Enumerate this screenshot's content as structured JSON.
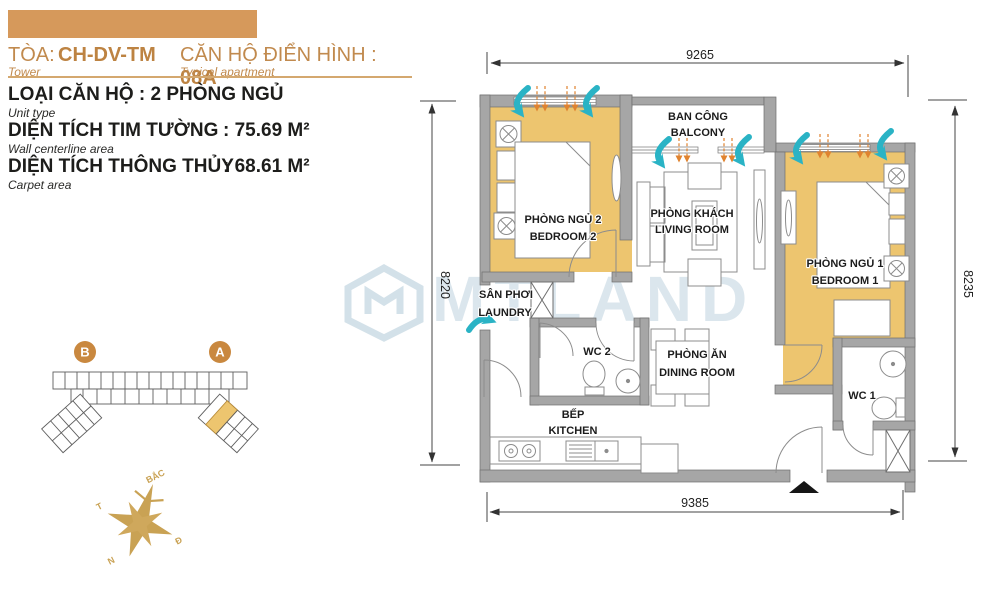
{
  "header": {
    "tower_label": "TÒA:",
    "tower_value": "CH-DV-TM",
    "tower_sub": "Tower",
    "apt_label": "CĂN HỘ ĐIỂN HÌNH : ",
    "apt_value": "08A",
    "apt_sub": "Typical apartment"
  },
  "specs": {
    "unit_type": "LOẠI CĂN HỘ : 2 PHÒNG NGỦ",
    "unit_type_sub": "Unit type",
    "wall_area_label": "DIỆN TÍCH TIM TƯỜNG",
    "wall_area_value": ": 75.69 M²",
    "wall_area_sub": "Wall centerline area",
    "carpet_area_label": "DIỆN TÍCH THÔNG THỦY",
    "carpet_area_value": ": 68.61 M²",
    "carpet_area_sub": "Carpet area"
  },
  "sitemap": {
    "tower_b": "B",
    "tower_a": "A"
  },
  "compass": {
    "north": "BẮC",
    "west": "T",
    "east": "Đ",
    "south": "N"
  },
  "watermark": "MTLAND",
  "floorplan": {
    "dims": {
      "top": "9265",
      "left": "8220",
      "right": "8235",
      "bottom": "9385"
    },
    "rooms": {
      "balcony": {
        "vi": "BAN CÔNG",
        "en": "BALCONY"
      },
      "bedroom2": {
        "vi": "PHÒNG NGỦ 2",
        "en": "BEDROOM 2"
      },
      "bedroom1": {
        "vi": "PHÒNG NGỦ 1",
        "en": "BEDROOM 1"
      },
      "living": {
        "vi": "PHÒNG KHÁCH",
        "en": "LIVING ROOM"
      },
      "laundry": {
        "vi": "SÂN PHƠI",
        "en": "LAUNDRY"
      },
      "dining": {
        "vi": "PHÒNG ĂN",
        "en": "DINING ROOM"
      },
      "kitchen": {
        "vi": "BẾP",
        "en": "KITCHEN"
      },
      "wc1": {
        "label": "WC 1"
      },
      "wc2": {
        "label": "WC 2"
      }
    }
  },
  "colors": {
    "header_bar": "#D6995B",
    "accent_tan": "#C18A4E",
    "room_highlight": "#EDC56F",
    "wall_gray": "#A6A6A6",
    "arrow_teal": "#2AB3C5",
    "arrow_orange": "#E0832F",
    "compass_gold": "#C9A254",
    "watermark_blue": "#AFC8D7"
  }
}
